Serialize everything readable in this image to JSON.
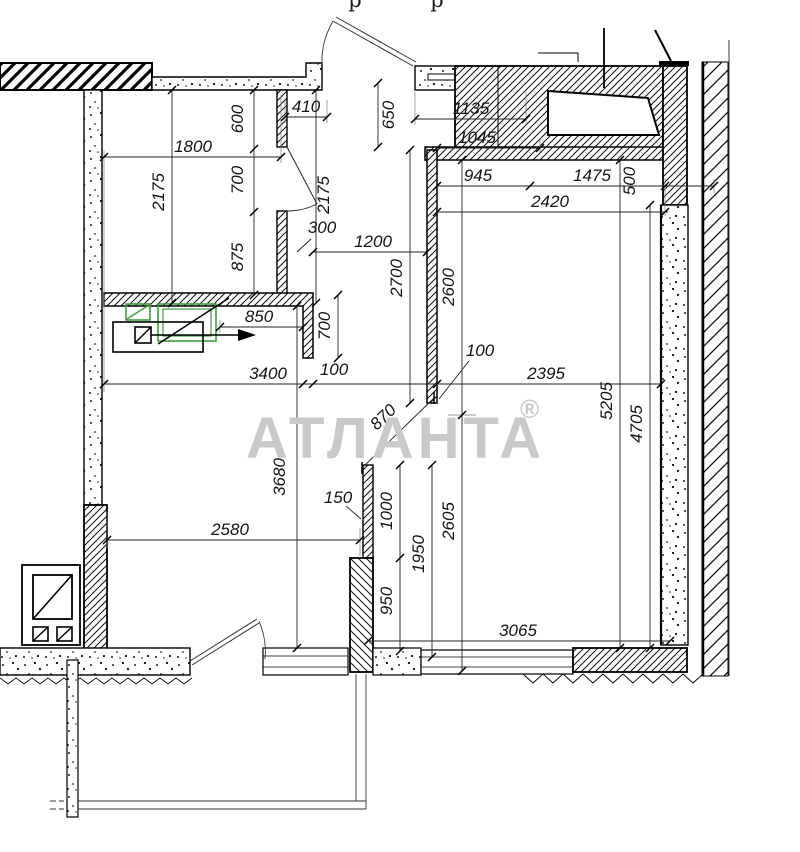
{
  "title": "Apartment floor plan technical drawing",
  "watermark": {
    "text": "АТЛАНТА",
    "reg": "®",
    "color": "#c9c9c9"
  },
  "top_cropped": {
    "left": "р",
    "right": "р"
  },
  "colors": {
    "furniture_green": "#3f9e3f",
    "line": "#141414"
  },
  "dims": {
    "d410": "410",
    "d600": "600",
    "d1800": "1800",
    "d2175_left": "2175",
    "d700_door": "700",
    "d2175_right": "2175",
    "d875": "875",
    "d300": "300",
    "d1200": "1200",
    "d2700": "2700",
    "d650": "650",
    "d1135": "1135",
    "d1045": "1045",
    "d945": "945",
    "d1475": "1475",
    "d500": "500",
    "d2420": "2420",
    "d2600": "2600",
    "d850": "850",
    "d700_stub": "700",
    "d3400": "3400",
    "d100_stub": "100",
    "d100_wall": "100",
    "d2395": "2395",
    "d870": "870",
    "d5205": "5205",
    "d4705": "4705",
    "d3680": "3680",
    "d150": "150",
    "d2580": "2580",
    "d1000": "1000",
    "d1950": "1950",
    "d2605": "2605",
    "d950": "950",
    "d3065": "3065"
  }
}
